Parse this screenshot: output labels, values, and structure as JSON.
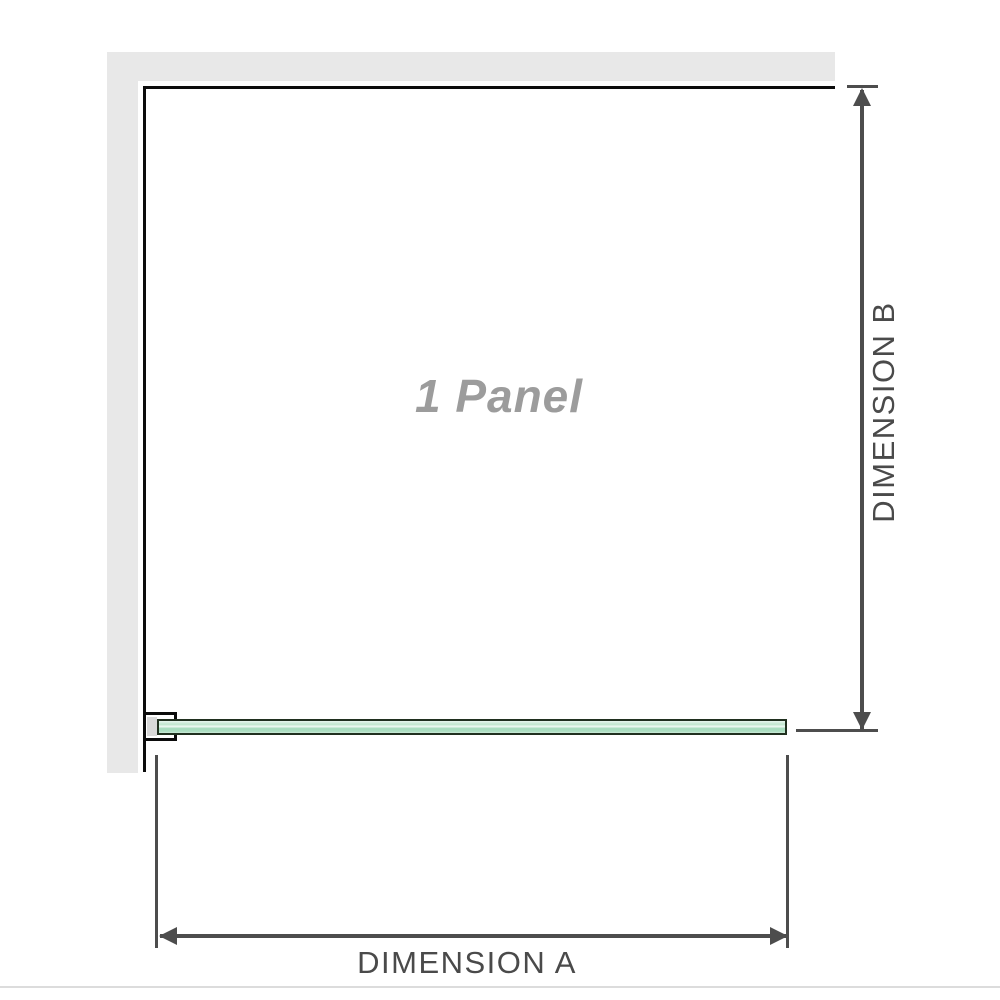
{
  "diagram": {
    "panel_label": "1 Panel",
    "dimension_a_label": "DIMENSION A",
    "dimension_b_label": "DIMENSION B"
  },
  "colors": {
    "wall_gray": "#e8e8e8",
    "panel_outline_black": "#0c0c0c",
    "dimension_gray": "#4d4d4d",
    "panel_label_gray": "#9c9c9c",
    "glass_green": "#a6dcbd",
    "glass_border": "#20301f",
    "bracket_pad_gray": "#d8d8d8",
    "bottom_edge_gray": "#dcdcdc"
  }
}
